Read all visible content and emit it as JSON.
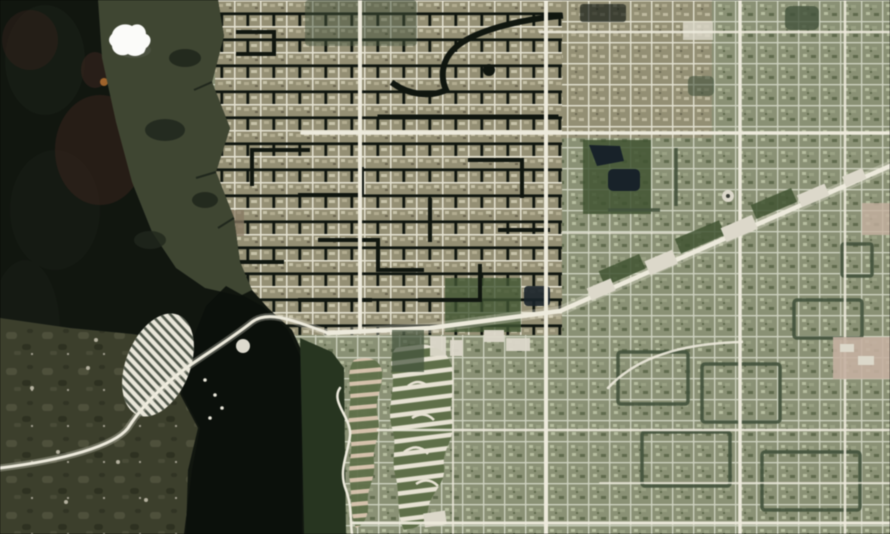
{
  "meta": {
    "type": "satellite-photo",
    "description": "Satellite view of a gulf-coast Florida suburb: dark estuary water and undeveloped marsh to the west, a white marina island linked by a causeway road, a canal-grid waterfront neighborhood, a diagonal commercial highway corridor running to the northeast, curved mobile-home park rows, and a vast rectilinear street grid with dark hedgerows, ponds and parks. A single small cumulus cloud sits over the wetland in the upper left.",
    "width_px": 890,
    "height_px": 534
  },
  "features": {
    "cloud": "small cumulus cloud",
    "estuary": "dark estuary water",
    "wetland": "coastal wetland band",
    "marsh": "undeveloped marshland",
    "river_channel": "dark tidal channel",
    "forest_strip": "riparian forest strip",
    "marina": "marina island with boat docks",
    "causeway": "causeway road across the estuary",
    "highway": "diagonal commercial highway corridor",
    "canal_district": "canal-grid waterfront neighborhood",
    "street_grid": "suburban street grid",
    "mobile_home_park": "curved rows of mobile homes",
    "ponds": "retention ponds",
    "commercial": "big-box commercial buildings"
  },
  "palette": {
    "water": "#11160f",
    "waterDeep": "#0b0f0b",
    "waterTint": "#1b2117",
    "wetland": "#3f4631",
    "wetlandShadow": "#20271c",
    "marshBase": "#3c3f2b",
    "marshLight": "#52543c",
    "marshDark": "#2e3120",
    "marshSpeck": "#c9c4b2",
    "forest": "#26351f",
    "mud": "#3a241c",
    "rust": "#b06a28",
    "clearing": "#8a7a62",
    "tanBase": "#948f72",
    "tanHouseLight": "#c8c2a6",
    "tanHouseMid": "#b3ac8e",
    "tanHouseDark": "#6b664f",
    "greenBase": "#8a9173",
    "greenHouseLight": "#b6bd9d",
    "greenHouseMid": "#9aa282",
    "greenHouseDark": "#5f6b4c",
    "street": "#e5e2d0",
    "streetFaint": "#cfd3bf",
    "canal": "#10160f",
    "hedge": "#41523a",
    "field": "#3f5530",
    "pond": "#17222a",
    "road": "#edeadb",
    "building": "#dcd8c9",
    "pink": "#c5b09e",
    "cloud": "#fbfbf9",
    "cloudShadow": "#6a7263",
    "trailerGreen": "#5e7046",
    "trailerWhite": "#e7e2d2",
    "trailerPeach": "#d9c3ac",
    "marinaWhite": "#e9e6d8",
    "marinaStripe": "#333d2f"
  }
}
